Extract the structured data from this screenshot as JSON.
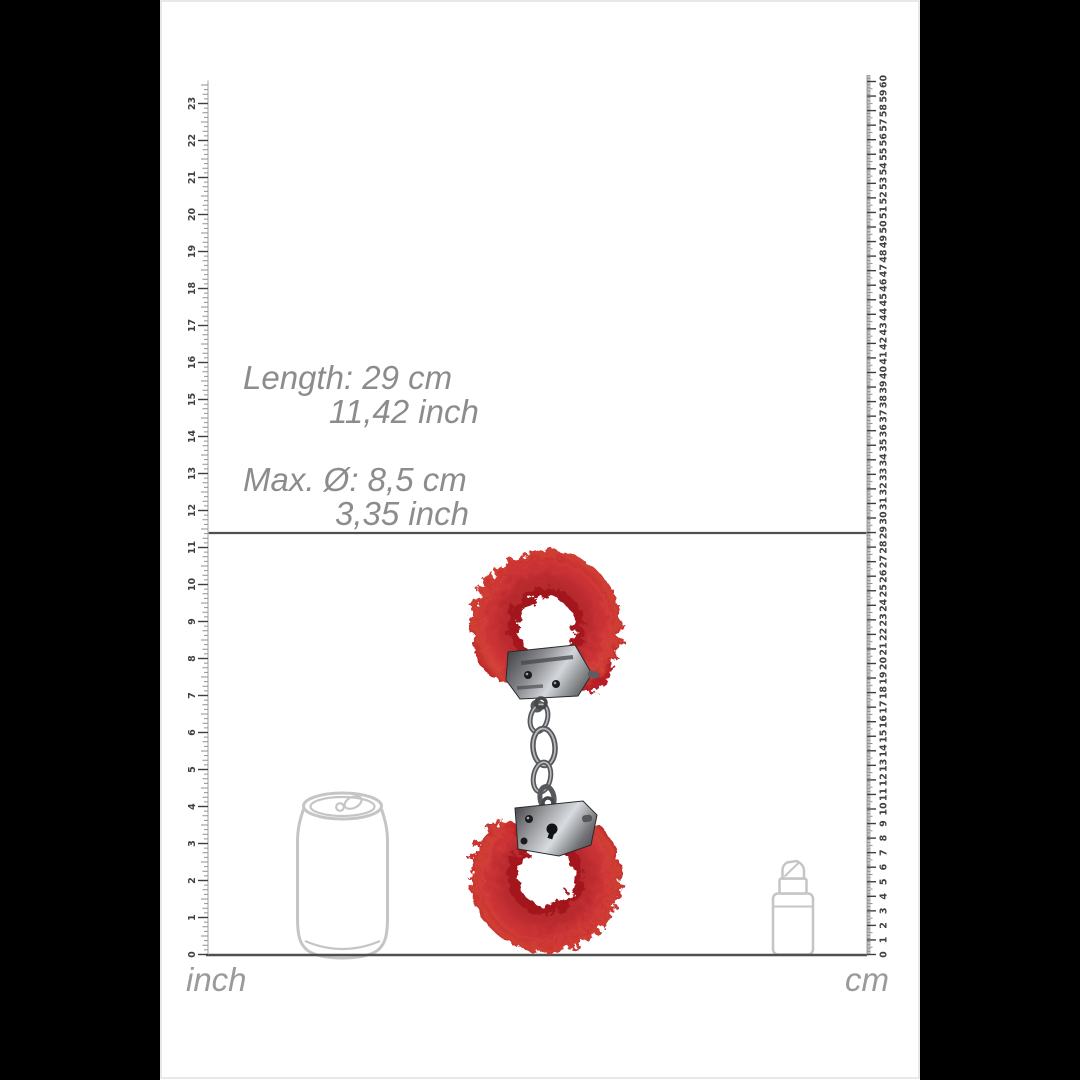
{
  "image_type": "product-dimension-diagram",
  "annotations": {
    "length_line1": "Length: 29 cm",
    "length_line2": "11,42 inch",
    "diameter_line1": "Max. Ø: 8,5 cm",
    "diameter_line2": "3,35 inch"
  },
  "product": {
    "type": "furry-handcuffs",
    "color": "red",
    "length": {
      "cm": "29",
      "inch": "11,42"
    },
    "max_diameter": {
      "cm": "8,5",
      "inch": "3,35"
    }
  },
  "reference_objects": [
    "soda-can",
    "lipstick"
  ],
  "rulers": {
    "inch": {
      "unit_label": "inch",
      "tick_labels": [
        0,
        1,
        2,
        3,
        4,
        5,
        6,
        7,
        8,
        9,
        10,
        11,
        12,
        13,
        14,
        15,
        16,
        17,
        18,
        19,
        20,
        21,
        22,
        23
      ],
      "subdivisions_per_unit": 8,
      "px_per_unit": 37.0,
      "origin_y": 954.5,
      "edge_x": 208,
      "tick_direction": -1,
      "overshoot_units": 0.62,
      "number_offset": 15.5,
      "tick_pattern": [
        10,
        4,
        5.5,
        4,
        7,
        4,
        5.5,
        4
      ]
    },
    "cm": {
      "unit_label": "cm",
      "tick_labels": [
        0,
        1,
        2,
        3,
        4,
        5,
        6,
        7,
        8,
        9,
        10,
        11,
        12,
        13,
        14,
        15,
        16,
        17,
        18,
        19,
        20,
        21,
        22,
        23,
        24,
        25,
        26,
        27,
        28,
        29,
        30,
        31,
        32,
        33,
        34,
        35,
        36,
        37,
        38,
        39,
        40,
        41,
        42,
        43,
        44,
        45,
        46,
        47,
        48,
        49,
        50,
        51,
        52,
        53,
        54,
        55,
        56,
        57,
        58,
        59,
        60
      ],
      "subdivisions_per_unit": 10,
      "px_per_unit": 14.55,
      "origin_y": 954.5,
      "edge_x": 867,
      "tick_direction": 1,
      "overshoot_units": 0.45,
      "number_offset": 17,
      "tick_pattern": [
        9,
        3.5,
        3.5,
        3.5,
        3.5,
        5.5,
        3.5,
        3.5,
        3.5,
        3.5
      ]
    }
  },
  "colors": {
    "letterbox": "#000000",
    "canvas": "#ffffff",
    "fur_red": "#c5232b",
    "fur_red_light": "#d9473a",
    "fur_red_dark": "#8e141b",
    "metal_light": "#cdd0d4",
    "metal_dark": "#35363a",
    "outline_gray": "#c5c5c5",
    "annotation_gray": "#8c8c8c",
    "line_gray": "#4f4f4f",
    "tick_gray": "#3e3e3e"
  }
}
